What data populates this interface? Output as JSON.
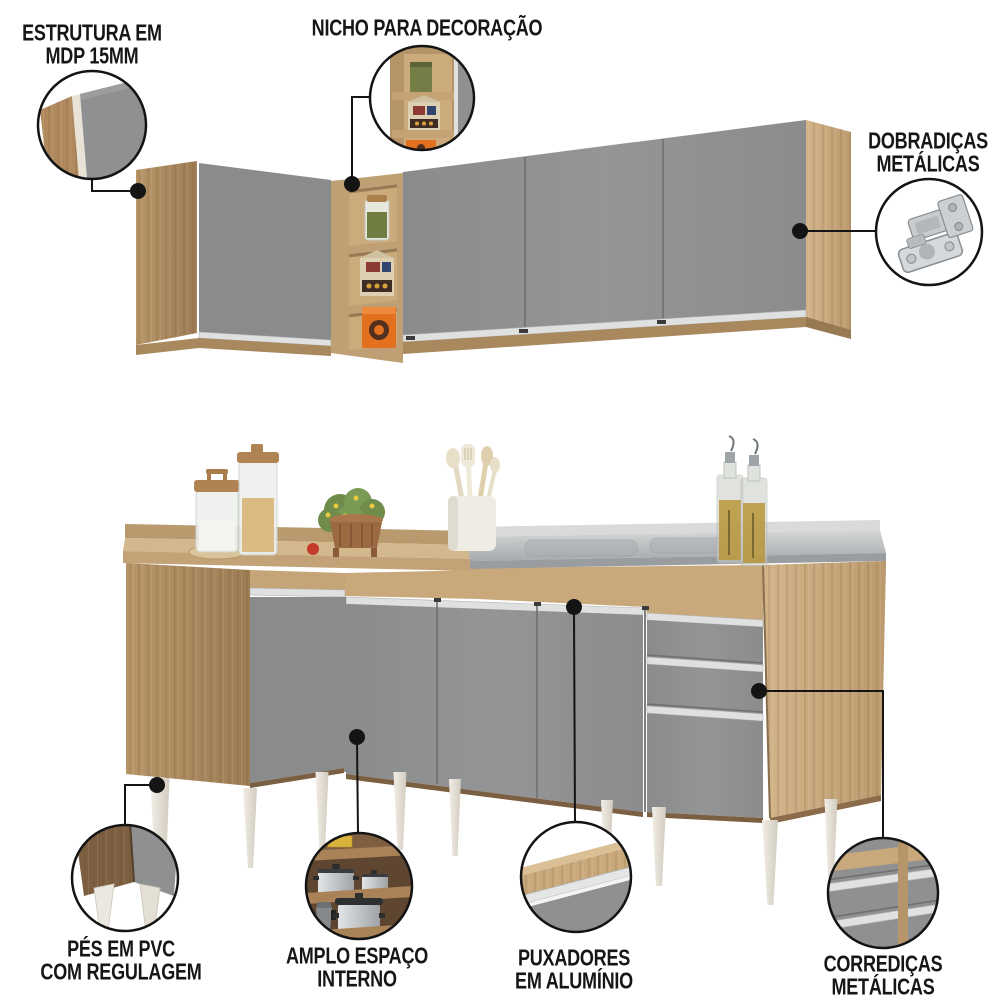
{
  "callouts": {
    "estrutura": {
      "lines": [
        "ESTRUTURA EM",
        "MDP 15MM"
      ],
      "inset": "panel-edge-closeup"
    },
    "nicho": {
      "lines": [
        "NICHO PARA DECORAÇÃO"
      ],
      "inset": "decor-niche-closeup"
    },
    "dobradicas": {
      "lines": [
        "DOBRADIÇAS",
        "METÁLICAS"
      ],
      "inset": "metal-hinge-closeup"
    },
    "pes": {
      "lines": [
        "PÉS EM PVC",
        "COM REGULAGEM"
      ],
      "inset": "pvc-adjustable-feet-closeup"
    },
    "amplo": {
      "lines": [
        "AMPLO ESPAÇO",
        "INTERNO"
      ],
      "inset": "interior-shelves-closeup"
    },
    "puxadores": {
      "lines": [
        "PUXADORES",
        "EM ALUMÍNIO"
      ],
      "inset": "aluminum-handle-closeup"
    },
    "corredicas": {
      "lines": [
        "CORREDIÇAS",
        "METÁLICAS"
      ],
      "inset": "metal-drawer-slides-closeup"
    }
  },
  "palette": {
    "wood": "#c9ab80",
    "wood_dark": "#a98a61",
    "door_gray": "#8d8e8f",
    "aluminum": "#dfe0e0",
    "steel": "#b9bcbe",
    "leg_white": "#ece8df",
    "line_black": "#141414",
    "accent_orange": "#e2701f"
  }
}
